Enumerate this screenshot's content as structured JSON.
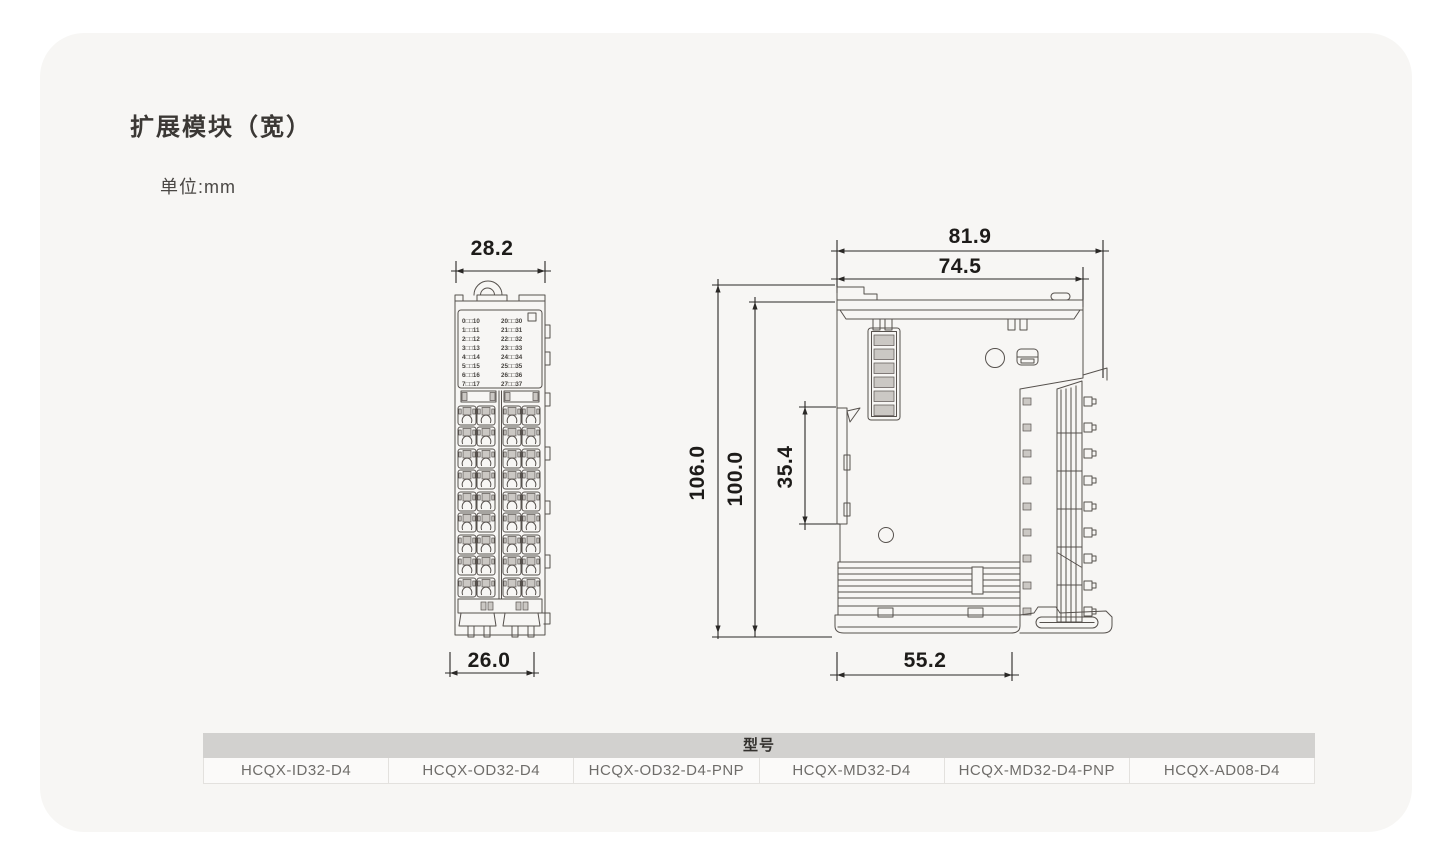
{
  "page": {
    "title": "扩展模块（宽）",
    "unit_label": "单位:mm"
  },
  "front_view": {
    "dim_top": "28.2",
    "dim_bottom": "26.0",
    "led_labels_left": [
      "0□□10",
      "1□□11",
      "2□□12",
      "3□□13",
      "4□□14",
      "5□□15",
      "6□□16",
      "7□□17"
    ],
    "led_labels_right": [
      "20□□30",
      "21□□31",
      "22□□32",
      "23□□33",
      "24□□34",
      "25□□35",
      "26□□36",
      "27□□37"
    ]
  },
  "side_view": {
    "dim_width_outer": "81.9",
    "dim_width_inner": "74.5",
    "dim_height_outer": "106.0",
    "dim_height_inner": "100.0",
    "dim_din_clip": "35.4",
    "dim_bottom": "55.2"
  },
  "model_table": {
    "header": "型号",
    "models": [
      "HCQX-ID32-D4",
      "HCQX-OD32-D4",
      "HCQX-OD32-D4-PNP",
      "HCQX-MD32-D4",
      "HCQX-MD32-D4-PNP",
      "HCQX-AD08-D4"
    ]
  },
  "colors": {
    "card_bg": "#f7f6f4",
    "line": "#56514d",
    "dim_text": "#1d1b19",
    "table_header_bg": "#d2d1cf",
    "table_text": "#6f6d6a"
  }
}
